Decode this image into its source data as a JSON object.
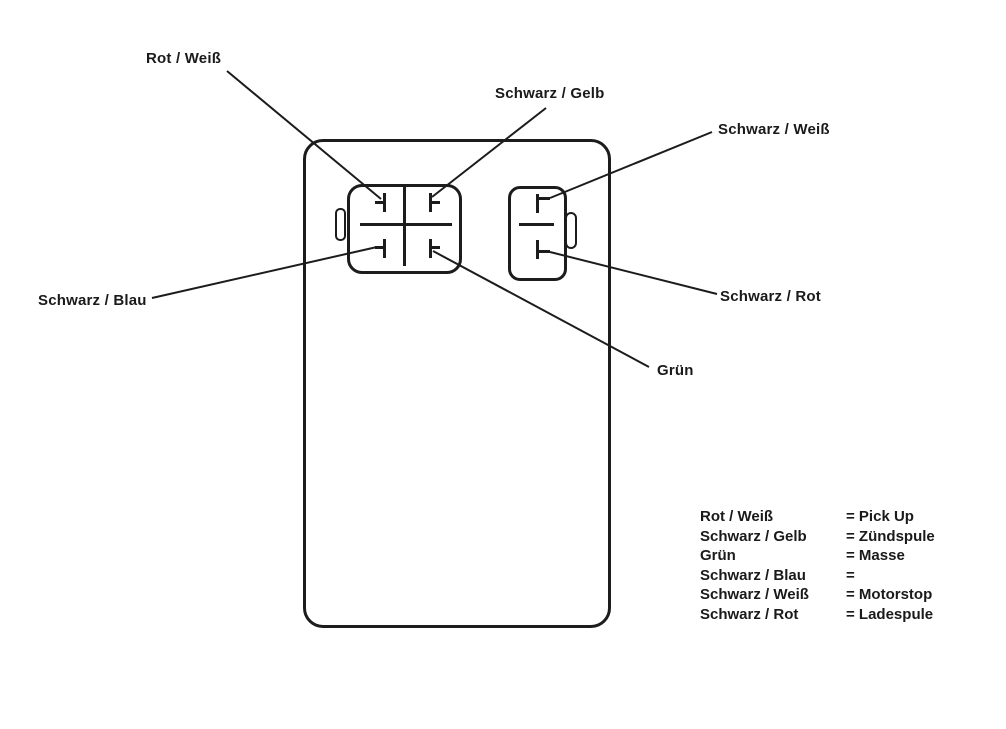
{
  "diagram": {
    "line_color": "#1c1c1c",
    "background": "#ffffff",
    "labels": {
      "rot_weiss": "Rot / Weiß",
      "schwarz_gelb": "Schwarz / Gelb",
      "schwarz_weiss": "Schwarz / Weiß",
      "schwarz_blau": "Schwarz / Blau",
      "gruen": "Grün",
      "schwarz_rot": "Schwarz / Rot"
    },
    "connectors": {
      "left": "4-pin-connector",
      "right": "2-pin-connector"
    }
  },
  "legend": {
    "rows": [
      {
        "wire": "Rot / Weiß",
        "function": "= Pick Up"
      },
      {
        "wire": "Schwarz / Gelb",
        "function": "= Zündspule"
      },
      {
        "wire": "Grün",
        "function": "= Masse"
      },
      {
        "wire": "Schwarz / Blau",
        "function": "="
      },
      {
        "wire": "Schwarz / Weiß",
        "function": "= Motorstop"
      },
      {
        "wire": "Schwarz / Rot",
        "function": "= Ladespule"
      }
    ]
  }
}
